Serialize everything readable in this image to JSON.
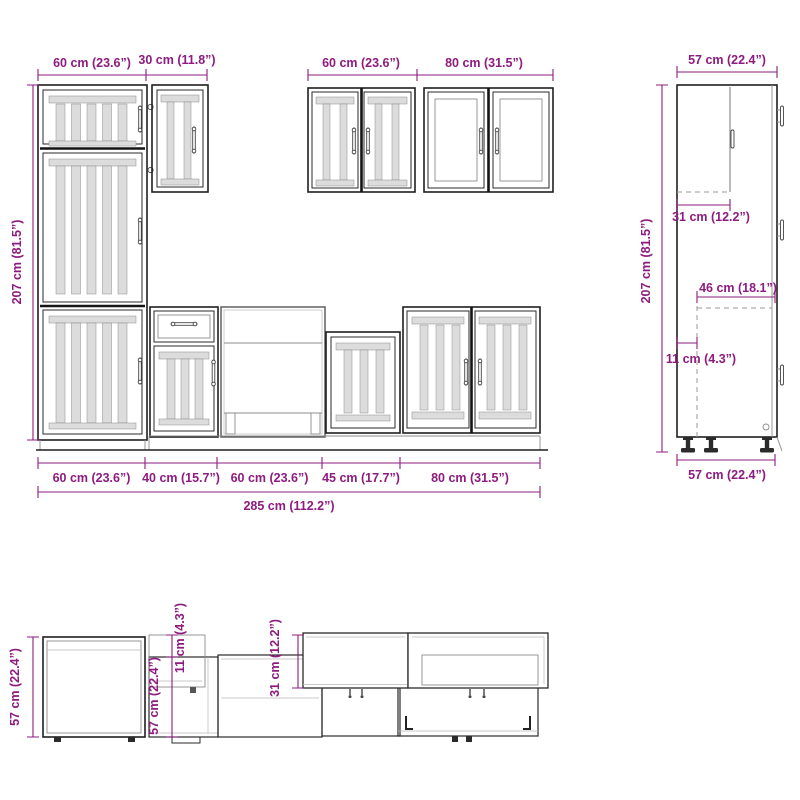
{
  "colors": {
    "dimension": "#8E1B7F",
    "outline": "#1a1a1a",
    "panel_fill": "#dcdcdc"
  },
  "front_view": {
    "top_widths": [
      "60 cm (23.6”)",
      "30 cm (11.8”)",
      "60 cm (23.6”)",
      "80 cm (31.5”)"
    ],
    "height": "207 cm (81.5”)",
    "bottom_widths": [
      "60 cm (23.6”)",
      "40 cm (15.7”)",
      "60 cm (23.6”)",
      "45 cm (17.7”)",
      "80 cm (31.5”)"
    ],
    "total_width": "285 cm (112.2”)"
  },
  "side_view": {
    "top_width": "57 cm (22.4”)",
    "height": "207 cm (81.5”)",
    "upper_section_depth": "31 cm (12.2”)",
    "interior_width": "46 cm (18.1”)",
    "plinth_recess": "11 cm (4.3”)",
    "bottom_width": "57 cm (22.4”)"
  },
  "plan_view": {
    "tall_cabinet_depth": "57 cm (22.4”)",
    "wall_cabinet_offset": "11 cm (4.3”)",
    "base_cabinet_depth": "57 cm (22.4”)",
    "wall_cabinet_depth": "31 cm (12.2”)"
  }
}
